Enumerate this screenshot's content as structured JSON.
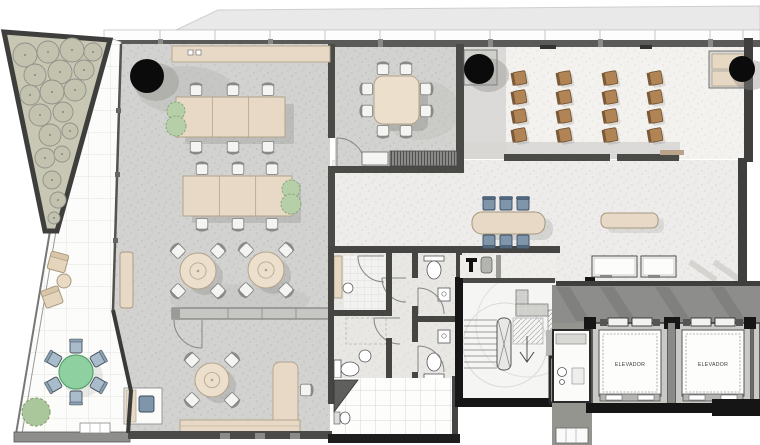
{
  "labels": {
    "elevator": "ELEVADOR"
  },
  "colors": {
    "wall_dark": "#4a4a47",
    "wall_black": "#161616",
    "floor_gray": "#d2d2d0",
    "floor_light": "#edecea",
    "floor_lecture": "#f3f2ef",
    "wood": "#e7d9c5",
    "wood_light": "#ecdfcb",
    "wood_stroke": "#b3a38b",
    "chair_white": "#f4f4f2",
    "chair_blue": "#7e95aa",
    "chair_blue_dark": "#3a4b60",
    "chair_brown": "#b08455",
    "chair_brown_back": "#7a5a38",
    "plant": "#b7cfa9",
    "plant_stroke": "#86a878",
    "terrace_table": "#8fd0a0",
    "corridor": "#8d8d8b",
    "garden": "#c7c7b3",
    "column": "#0b0b0b"
  },
  "elevators": [
    {
      "x": 592,
      "y": 323,
      "w": 76,
      "label": "ELEVADOR"
    },
    {
      "x": 675,
      "y": 323,
      "w": 76,
      "label": "ELEVADOR"
    },
    {
      "x": 753,
      "y": 323,
      "w": 7,
      "label": ""
    }
  ],
  "columns": [
    {
      "cx": 147,
      "cy": 76,
      "r": 17
    },
    {
      "cx": 479,
      "cy": 69,
      "r": 15
    },
    {
      "cx": 742,
      "cy": 69,
      "r": 13
    }
  ],
  "garden_trees": [
    [
      25,
      55,
      12
    ],
    [
      48,
      52,
      11
    ],
    [
      72,
      50,
      12
    ],
    [
      93,
      52,
      9
    ],
    [
      35,
      75,
      11
    ],
    [
      60,
      72,
      12
    ],
    [
      84,
      70,
      10
    ],
    [
      30,
      95,
      10
    ],
    [
      52,
      92,
      12
    ],
    [
      75,
      90,
      11
    ],
    [
      40,
      115,
      11
    ],
    [
      63,
      112,
      10
    ],
    [
      50,
      135,
      11
    ],
    [
      70,
      131,
      8
    ],
    [
      45,
      158,
      10
    ],
    [
      62,
      154,
      8
    ],
    [
      52,
      180,
      9
    ],
    [
      58,
      200,
      8
    ],
    [
      54,
      218,
      6
    ]
  ],
  "long_tables": [
    {
      "x": 176,
      "y": 97,
      "w": 109,
      "h": 40,
      "chair_xs": [
        196,
        233,
        268
      ],
      "chair_y_top": 90,
      "chair_y_bottom": 147,
      "plant": [
        176,
        118
      ]
    },
    {
      "x": 183,
      "y": 176,
      "w": 109,
      "h": 40,
      "chair_xs": [
        202,
        238,
        272
      ],
      "chair_y_top": 169,
      "chair_y_bottom": 224,
      "plant": [
        291,
        196
      ]
    }
  ],
  "round_tables": [
    {
      "cx": 198,
      "cy": 271,
      "r": 18
    },
    {
      "cx": 266,
      "cy": 270,
      "r": 18
    },
    {
      "cx": 212,
      "cy": 380,
      "r": 17
    }
  ],
  "meeting_table": {
    "x": 374,
    "y": 76,
    "w": 45,
    "h": 48
  },
  "blue_table": {
    "x": 472,
    "y": 212,
    "w": 73,
    "h": 22,
    "chair_xs": [
      489,
      506,
      523
    ],
    "chair_y_top": 204,
    "chair_y_bottom": 241
  },
  "hall_bench": {
    "x": 601,
    "y": 213,
    "w": 57,
    "h": 15
  },
  "lecture_chairs": {
    "cols": [
      520,
      565,
      611,
      656
    ],
    "rows": [
      78,
      97,
      116,
      135
    ]
  },
  "terrace": {
    "green_table": {
      "cx": 76,
      "cy": 372,
      "r": 17
    },
    "chair_angles": [
      210,
      270,
      330,
      30,
      90,
      150
    ],
    "bush": {
      "cx": 36,
      "cy": 412,
      "r": 14
    },
    "lounge": [
      {
        "x": 58,
        "y": 262,
        "rot": 15
      },
      {
        "x": 52,
        "y": 297,
        "rot": -20
      }
    ],
    "side_table": {
      "cx": 64,
      "cy": 281,
      "r": 7
    }
  }
}
